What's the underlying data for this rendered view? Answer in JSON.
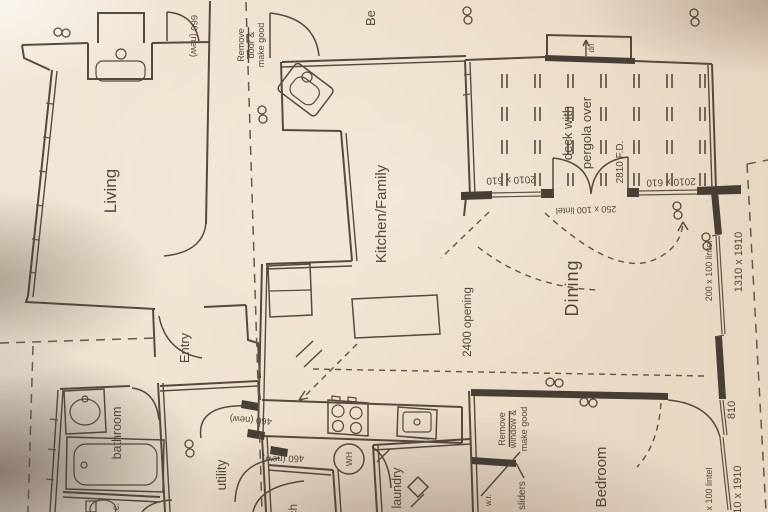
{
  "plan": {
    "rooms": {
      "living": "Living",
      "kitchen_family": "Kitchen/Family",
      "dining": "Dining",
      "deck": [
        "deck with",
        "pergola over"
      ],
      "entry": "Entry",
      "bathroom": "bathroom",
      "utility": "utility",
      "laundry": "laundry",
      "bedroom": "Bedroom",
      "wc": "w.c.",
      "porch": "porch",
      "partial_room": "Be"
    },
    "notes": {
      "remove_door": [
        "Remove",
        "door &",
        "make good"
      ],
      "remove_window": [
        "Remove",
        "window &",
        "make good"
      ],
      "sliders": "sliders",
      "wr": "w.r.",
      "stair": "dn"
    },
    "dims": {
      "opening_2400": "2400 opening",
      "door_660": "660 (new)",
      "door_460_a": "460 (new)",
      "door_460_b": "460 (new)",
      "deck_window_left": "2010 x 610",
      "deck_window_right": "2010 x 610",
      "french_doors": "2810 F.D.",
      "deck_lintel": "250 x 100 lintel",
      "dining_lintel": "200 x 100 lintel",
      "dining_window": "1310 x 1910",
      "bedroom_door": "810",
      "bedroom_lintel": "200 x 100 lintel",
      "bedroom_window": "1310 x 1910"
    },
    "fixtures": {
      "water_heater": "WH"
    },
    "colors": {
      "paper": "#eee0cd",
      "ink": "#4a3f33"
    }
  }
}
